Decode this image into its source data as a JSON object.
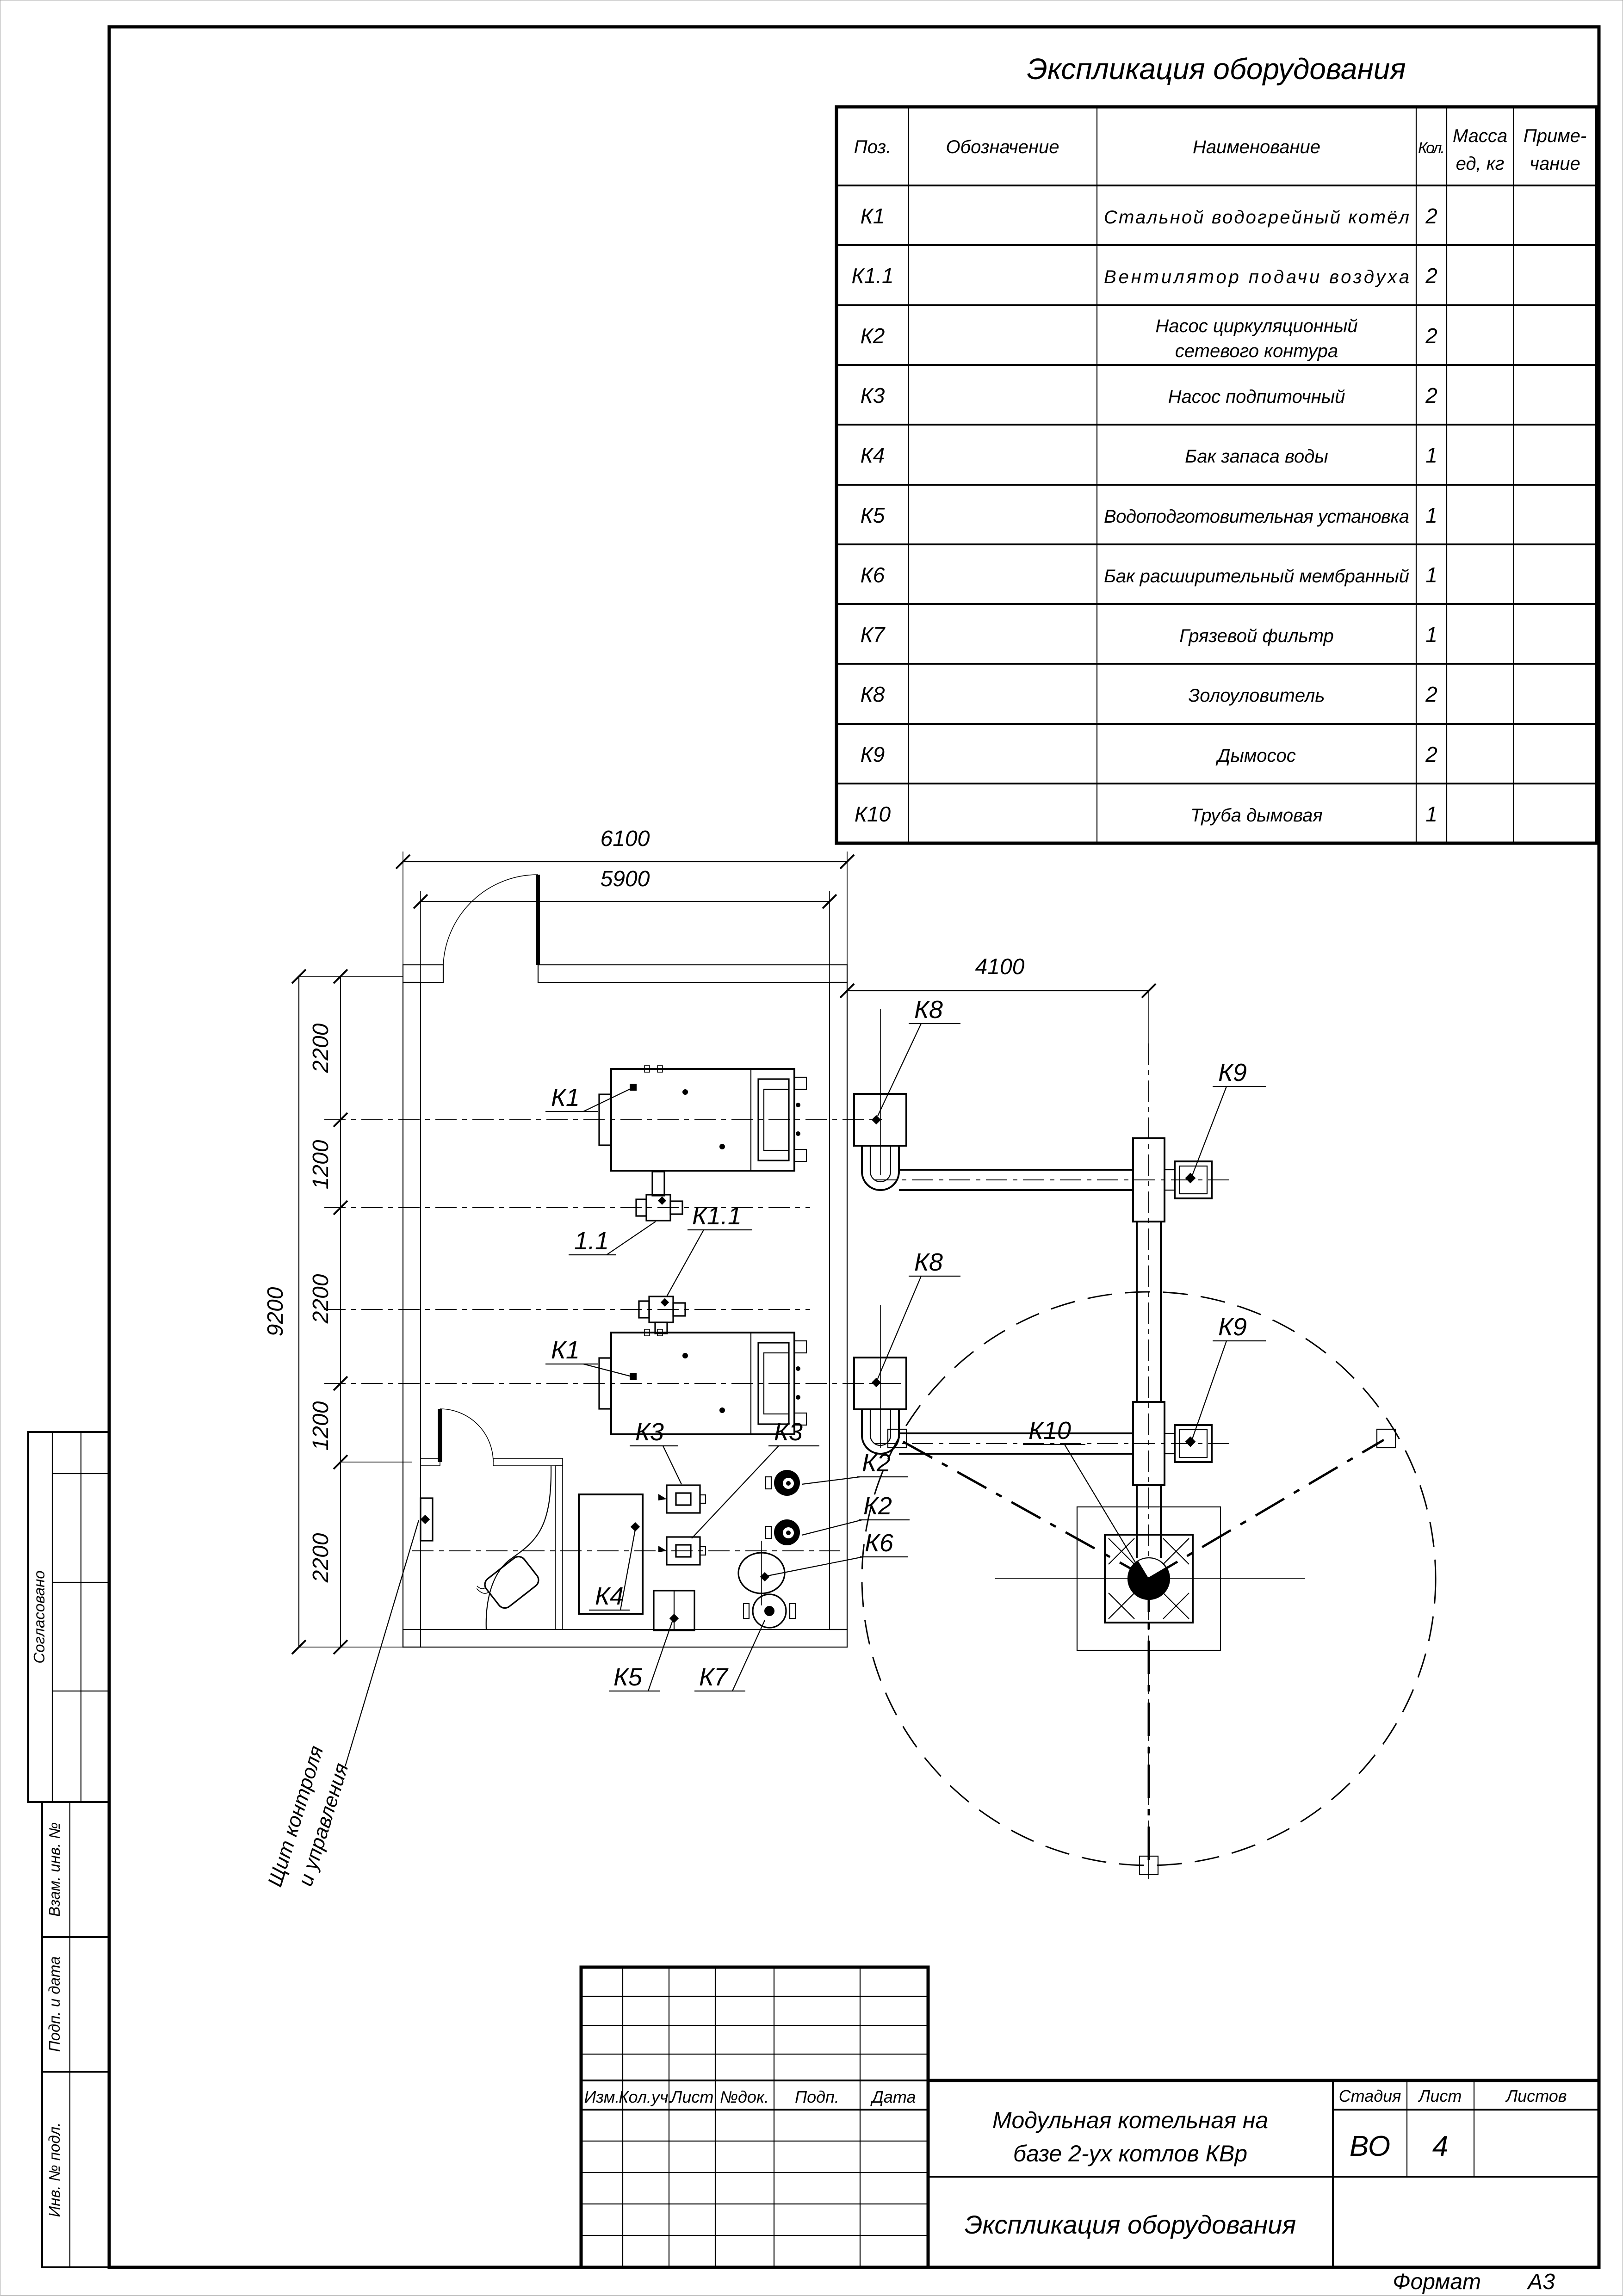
{
  "sheet": {
    "equipment_table": {
      "title": "Экспликация оборудования",
      "columns": {
        "pos": "Поз.",
        "designation": "Обозначение",
        "name": "Наименование",
        "qty": "Кол.",
        "mass_line1": "Масса",
        "mass_line2": "ед, кг",
        "note_line1": "Приме-",
        "note_line2": "чание"
      },
      "rows": [
        {
          "pos": "К1",
          "name": "Стальной водогрейный котёл",
          "qty": "2"
        },
        {
          "pos": "К1.1",
          "name": "Вентилятор подачи воздуха",
          "qty": "2"
        },
        {
          "pos": "К2",
          "name_line1": "Насос циркуляционный",
          "name_line2": "сетевого контура",
          "qty": "2"
        },
        {
          "pos": "К3",
          "name": "Насос подпиточный",
          "qty": "2"
        },
        {
          "pos": "К4",
          "name": "Бак запаса воды",
          "qty": "1"
        },
        {
          "pos": "К5",
          "name": "Водоподготовительная установка",
          "qty": "1"
        },
        {
          "pos": "К6",
          "name": "Бак расширительный мембранный",
          "qty": "1"
        },
        {
          "pos": "К7",
          "name": "Грязевой фильтр",
          "qty": "1"
        },
        {
          "pos": "К8",
          "name": "Золоуловитель",
          "qty": "2"
        },
        {
          "pos": "К9",
          "name": "Дымосос",
          "qty": "2"
        },
        {
          "pos": "К10",
          "name": "Труба дымовая",
          "qty": "1"
        }
      ]
    },
    "plan": {
      "dims": {
        "d6100": "6100",
        "d5900": "5900",
        "d4100": "4100",
        "d9200": "9200",
        "segments": [
          "2200",
          "1200",
          "2200",
          "1200",
          "2200"
        ]
      },
      "labels": {
        "k1a": "К1",
        "k11a": "1.1",
        "k11b": "К1.1",
        "k1b": "К1",
        "k8a": "К8",
        "k8b": "К8",
        "k9a": "К9",
        "k9b": "К9",
        "k10": "К10",
        "k2a": "К2",
        "k2b": "К2",
        "k3a": "К3",
        "k3b": "К3",
        "k4": "К4",
        "k5": "К5",
        "k6": "К6",
        "k7": "К7"
      },
      "annotation_line1": "Щит контроля",
      "annotation_line2": "и управления"
    },
    "title_block": {
      "cols": {
        "izm": "Изм.",
        "koluch": "Кол.уч.",
        "list": "Лист",
        "ndok": "№док.",
        "podp": "Подп.",
        "data": "Дата"
      },
      "project_line1": "Модульная котельная на",
      "project_line2": "базе 2-ух котлов КВр",
      "stage_label": "Стадия",
      "sheet_label": "Лист",
      "sheets_label": "Листов",
      "stage_value": "ВО",
      "sheet_value": "4",
      "doc_title": "Экспликация оборудования",
      "format_label": "Формат",
      "format_value": "А3"
    },
    "side_stamps": {
      "agreed": "Согласовано",
      "vzam": "Взам. инв. №",
      "podp": "Подп. и дата",
      "inv": "Инв. № подл."
    }
  }
}
